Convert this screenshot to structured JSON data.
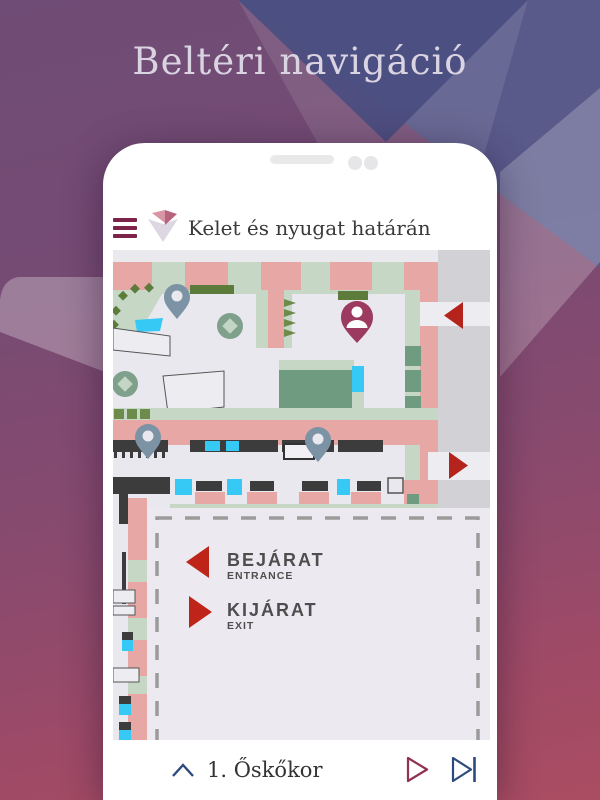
{
  "background": {
    "title": "Beltéri navigáció"
  },
  "app": {
    "header": {
      "menu_icon": "hamburger-menu-icon",
      "logo_icon": "museum-logo-icon",
      "title": "Kelet és nyugat határán"
    },
    "map": {
      "legend": {
        "entrance_label": "BEJÁRAT",
        "entrance_sublabel": "ENTRANCE",
        "exit_label": "KIJÁRAT",
        "exit_sublabel": "EXIT"
      },
      "markers": {
        "visitor_marker": "person-pin",
        "poi_markers": "location-pins",
        "entrance_arrow": "red-arrow-left",
        "exit_arrow": "red-arrow-right"
      }
    },
    "bottom_bar": {
      "collapse_icon": "chevron-up-icon",
      "station_label": "1. Őskőkor",
      "play_icon": "play-icon",
      "next_icon": "skip-next-icon"
    }
  },
  "colors": {
    "accent_maroon": "#7d2248",
    "pin_gray": "#7b93a4",
    "person_pin": "#9d3a5f",
    "arrow_red": "#b5231d",
    "wall_pink": "#e7a8a5",
    "floor_green": "#c6d7c6",
    "room_green": "#6f9c80",
    "highlight_cyan": "#36c9f6",
    "nav_navy": "#2c4a7e",
    "play_maroon": "#913250"
  }
}
